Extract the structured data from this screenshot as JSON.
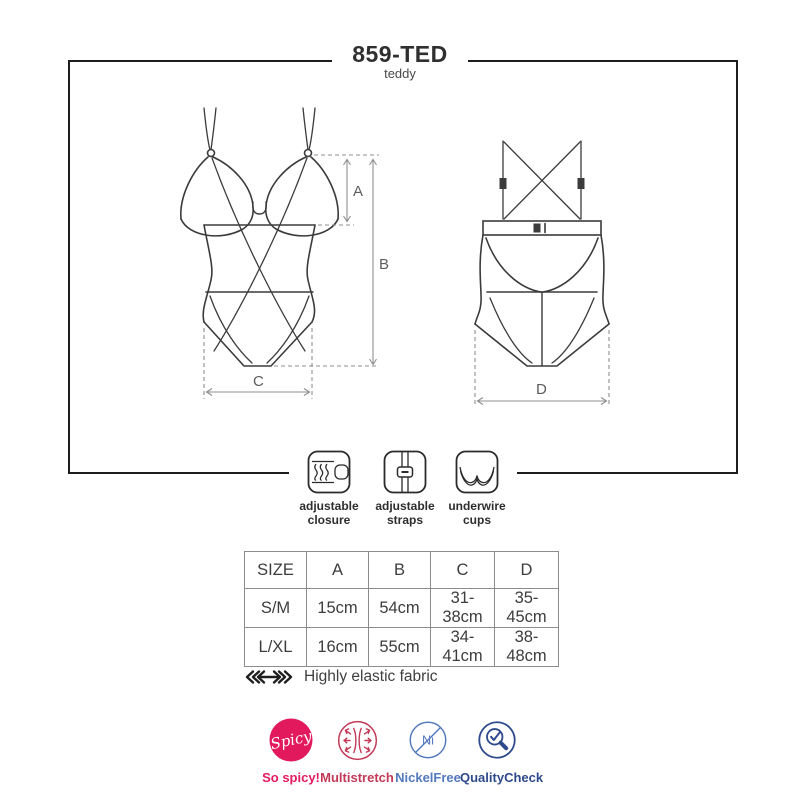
{
  "title": {
    "model": "859-TED",
    "type": "teddy"
  },
  "diagram": {
    "views": [
      "front",
      "back"
    ],
    "labels": {
      "a": "A",
      "b": "B",
      "c": "C",
      "d": "D"
    }
  },
  "features": [
    {
      "icon": "hook-closure-icon",
      "line1": "adjustable",
      "line2": "closure"
    },
    {
      "icon": "strap-slider-icon",
      "line1": "adjustable",
      "line2": "straps"
    },
    {
      "icon": "underwire-cups-icon",
      "line1": "underwire",
      "line2": "cups"
    }
  ],
  "size_table": {
    "headers": [
      "SIZE",
      "A",
      "B",
      "C",
      "D"
    ],
    "rows": [
      [
        "S/M",
        "15cm",
        "54cm",
        "31-38cm",
        "35-45cm"
      ],
      [
        "L/XL",
        "16cm",
        "55cm",
        "34-41cm",
        "38-48cm"
      ]
    ]
  },
  "fabric_note": {
    "icon": "stretch-arrows-icon",
    "text": "Highly elastic fabric"
  },
  "badges": [
    {
      "name": "spicy",
      "circle_text": "Spicy",
      "label": "So spicy!",
      "color": "#e31b5f"
    },
    {
      "name": "multistretch",
      "circle_text": "",
      "label": "Multistretch",
      "color": "#c23a57"
    },
    {
      "name": "nickel-free",
      "circle_text": "Ni",
      "label": "NickelFree",
      "color": "#5479be"
    },
    {
      "name": "quality-check",
      "circle_text": "",
      "label": "QualityCheck",
      "color": "#2e4a8c"
    }
  ],
  "colors": {
    "line_art": "#3b3b3b",
    "dimension": "#8f8f8f",
    "frame": "#1d1d1d"
  }
}
